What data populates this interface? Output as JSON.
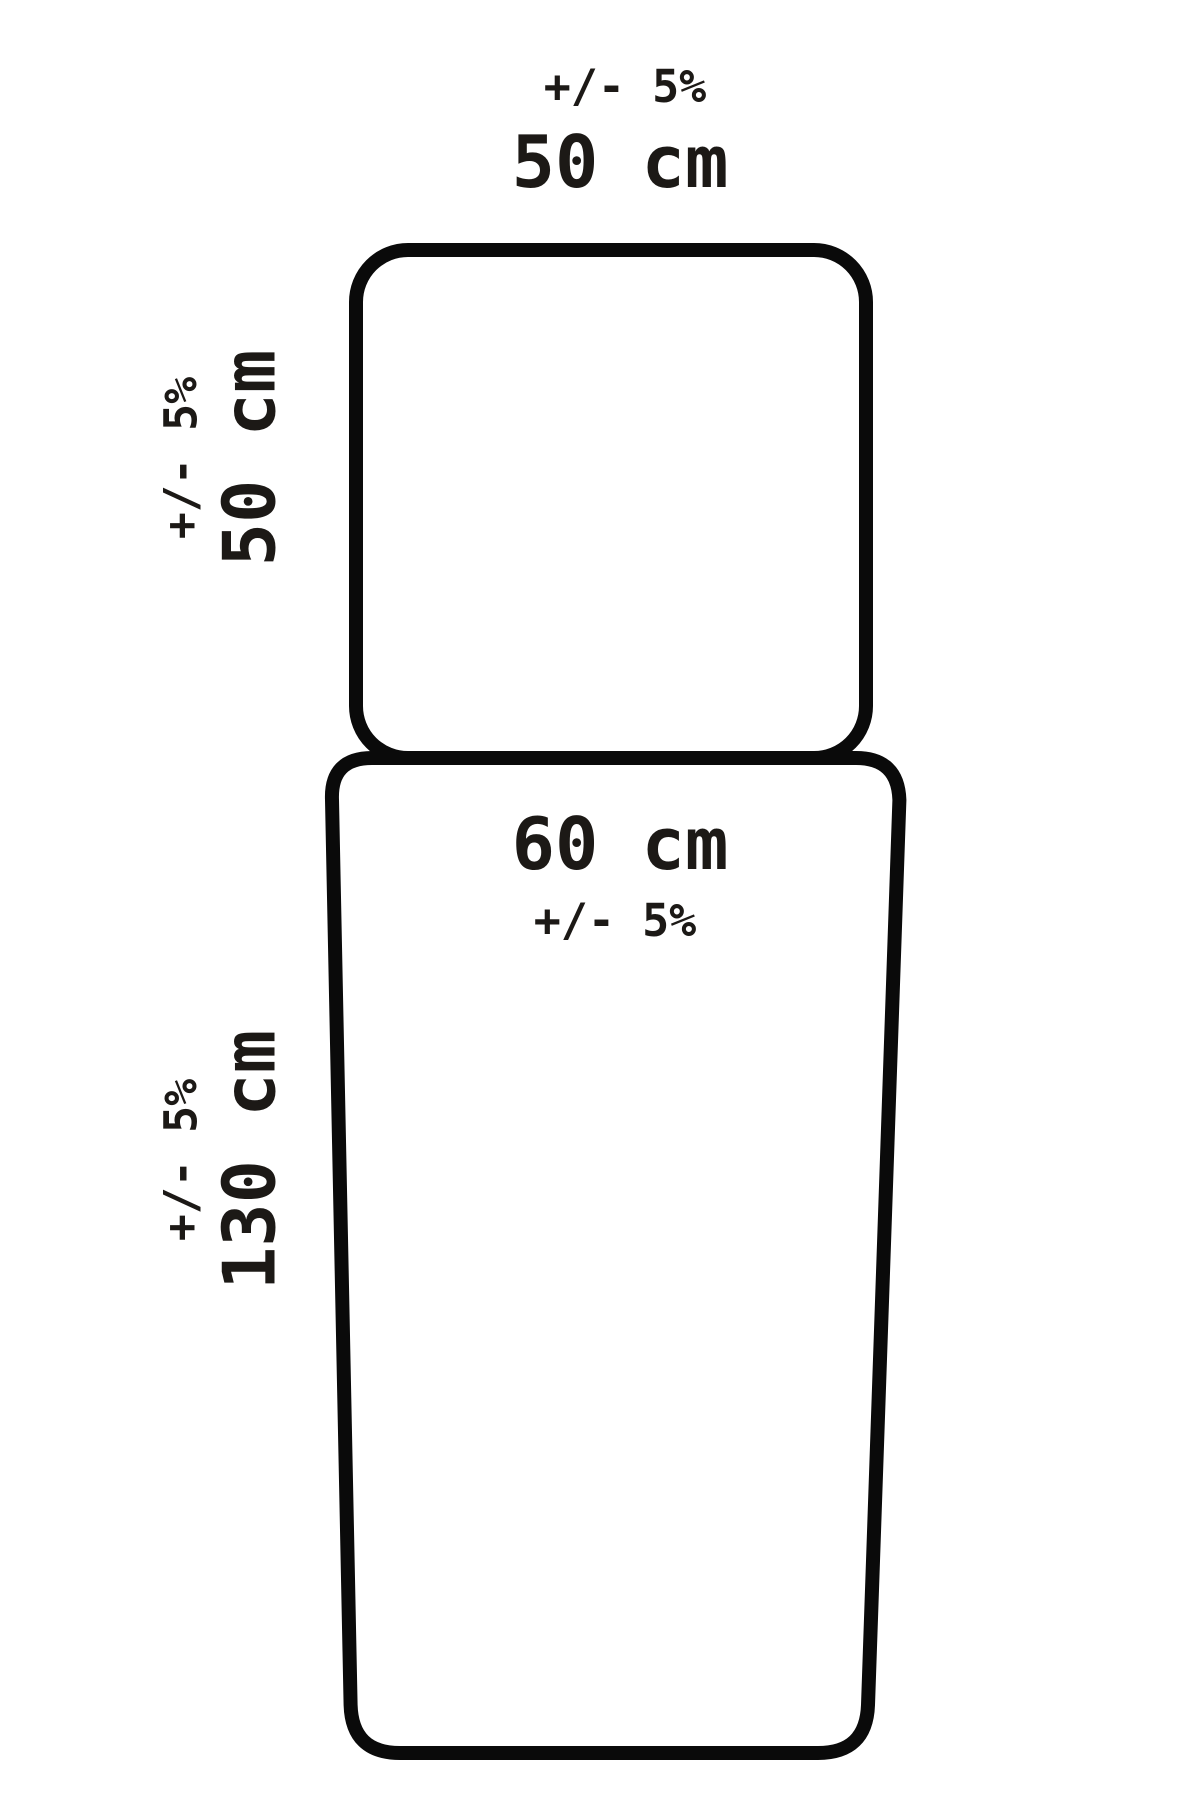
{
  "colors": {
    "bg": "#ffffff",
    "stroke": "#0a0a0a",
    "text": "#1c1916"
  },
  "top_shape": {
    "top_label": {
      "tolerance": "+/- 5%",
      "value": "50 cm"
    },
    "side_label": {
      "tolerance": "+/- 5%",
      "value": "50 cm"
    }
  },
  "bottom_shape": {
    "inner_label": {
      "value": "60 cm",
      "tolerance": "+/- 5%"
    },
    "side_label": {
      "tolerance": "+/- 5%",
      "value": "130 cm"
    }
  }
}
